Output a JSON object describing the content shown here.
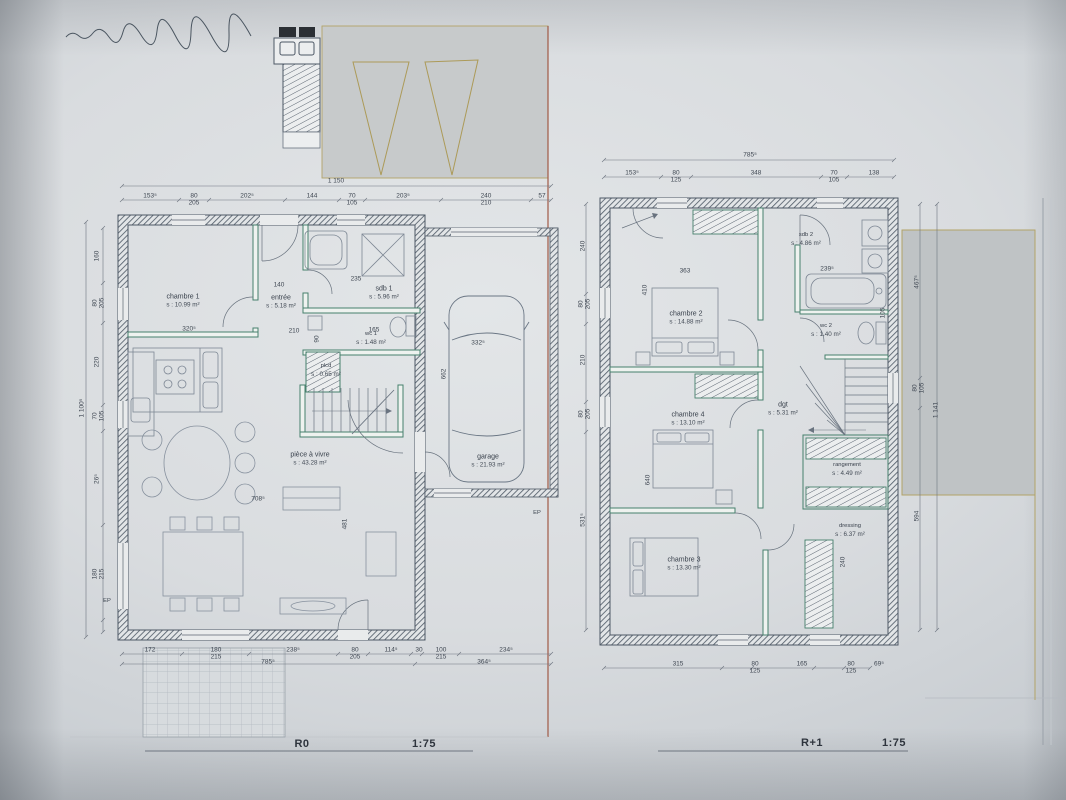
{
  "colors": {
    "wall_ink": "#4d5865",
    "partition_green": "#46806c",
    "boundary_red": "#a05a46",
    "boundary_tan": "#b2a368",
    "paper": "#d9dcdf"
  },
  "left_plan": {
    "title": "R0",
    "scale": "1:75",
    "rooms": [
      {
        "label": "chambre 1",
        "area": "s : 10.99 m²"
      },
      {
        "label": "entrée",
        "area": "s : 5.18 m²"
      },
      {
        "label": "sdb 1",
        "area": "s : 5.96 m²"
      },
      {
        "label": "wc 1",
        "area": "s : 1.48 m²"
      },
      {
        "label": "plcd",
        "area": "s : 0.65 m²"
      },
      {
        "label": "pièce à vivre",
        "area": "s : 43.28 m²"
      },
      {
        "label": "garage",
        "area": "s : 21.93 m²"
      }
    ],
    "ep_label": "EP",
    "dims": {
      "overall_top": "1 150",
      "overall_left": "1 100⁵",
      "top": [
        "153⁵",
        "80\n205",
        "202⁵",
        "144",
        "70\n105",
        "203⁵",
        "240\n210",
        "57"
      ],
      "left": [
        "160",
        "80\n205",
        "220",
        "70\n105",
        "26⁵",
        "180\n215"
      ],
      "bottom": [
        "172",
        "180\n215",
        "238⁵",
        "80\n205",
        "114⁵",
        "30",
        "100\n215",
        "234⁵"
      ],
      "bottom2": [
        "785⁵",
        "364⁵"
      ],
      "inner": [
        "140",
        "235",
        "210",
        "165",
        "320⁵",
        "708⁵",
        "481",
        "90",
        "332⁵",
        "662"
      ]
    }
  },
  "right_plan": {
    "title": "R+1",
    "scale": "1:75",
    "rooms": [
      {
        "label": "chambre 2",
        "area": "s : 14.88 m²"
      },
      {
        "label": "sdb 2",
        "area": "s : 4.86 m²"
      },
      {
        "label": "wc 2",
        "area": "s : 1.40 m²"
      },
      {
        "label": "chambre 4",
        "area": "s : 13.10 m²"
      },
      {
        "label": "dgt",
        "area": "s : 5.31 m²"
      },
      {
        "label": "rangement",
        "area": "s : 4.49 m²"
      },
      {
        "label": "dressing",
        "area": "s : 6.37 m²"
      },
      {
        "label": "chambre 3",
        "area": "s : 13.30 m²"
      }
    ],
    "dims": {
      "overall_top": "785⁵",
      "overall_right": "1 141",
      "top": [
        "153⁵",
        "80\n125",
        "348",
        "70\n105",
        "138"
      ],
      "left": [
        "240",
        "80\n205",
        "210",
        "80\n205",
        "531⁵"
      ],
      "right": [
        "467⁵",
        "80\n105",
        "594"
      ],
      "bottom": [
        "315",
        "80\n125",
        "165",
        "80\n125",
        "69⁵"
      ],
      "inner": [
        "363",
        "239⁵",
        "410",
        "105",
        "640",
        "240"
      ]
    }
  }
}
